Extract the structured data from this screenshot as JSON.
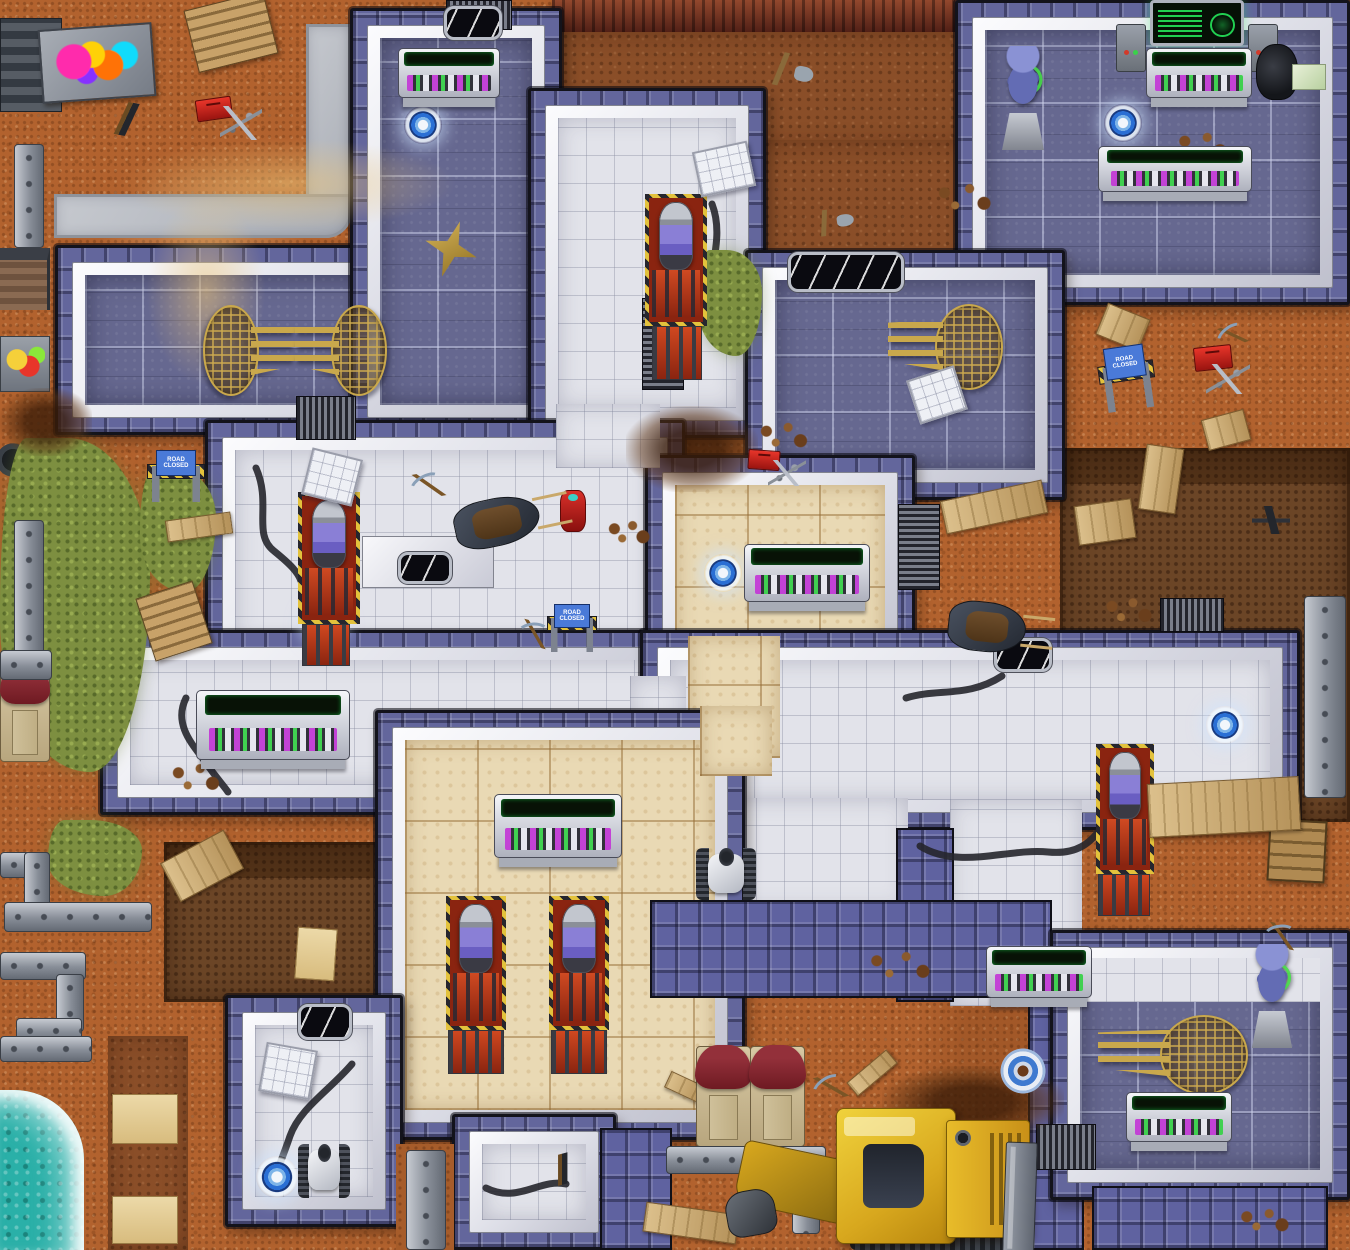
{
  "meta": {
    "title": "Sci-fi facility top-down game map",
    "width": 1350,
    "height": 1250
  },
  "palette": {
    "dirt": "#b2622e",
    "dark_dirt": "#8a4e28",
    "pit": "#5a3a22",
    "cliff": "#6e2a1e",
    "blue_floor": "#666890",
    "white_floor": "#e2e3ea",
    "tan_floor": "#e9d9b4",
    "wall_white": "#dcdde6",
    "wall_pillar": "#63669c",
    "water": "#2ab0a8",
    "grass": "#7d8f40",
    "hazard_yellow": "#e3c23c",
    "teleporter_blue": "#2a6fd4",
    "emblem_gold": "#c9a84c",
    "screen_green": "#28ff64",
    "console_magenta": "#c33bd6",
    "toolbox_red": "#d8302a",
    "bulldozer_yellow": "#d8a81e",
    "porta_potty_roof": "#93303a"
  },
  "signs": {
    "road_closed": "ROAD CLOSED"
  },
  "inventory": {
    "teleporters": 6,
    "target_markers": 1,
    "consoles": 8,
    "wall_screens": 1,
    "hydraulic_presses": 5,
    "robots": 2,
    "alien_statues": 2,
    "gold_emblems": 4,
    "road_closed_barricades": 3,
    "porta_potties": 3,
    "bulldozers": 1,
    "wheelbarrows": 2,
    "toolboxes": 3,
    "graffiti_walls": 1,
    "windows": 5
  },
  "props": [
    {
      "t": "grass",
      "n": "grass-patch",
      "x": 0,
      "y": 438,
      "w": 150,
      "h": 334
    },
    {
      "t": "grass",
      "n": "grass-patch",
      "x": 140,
      "y": 468,
      "w": 76,
      "h": 124
    },
    {
      "t": "grass",
      "n": "grass-patch",
      "x": 48,
      "y": 820,
      "w": 94,
      "h": 76
    },
    {
      "t": "grass",
      "n": "grass-patch",
      "x": 698,
      "y": 250,
      "w": 64,
      "h": 106
    },
    {
      "t": "sand",
      "n": "sand-streak",
      "x": 118,
      "y": 138,
      "w": 340,
      "h": 92
    },
    {
      "t": "sand",
      "n": "sand-streak",
      "x": 146,
      "y": 196,
      "w": 120,
      "h": 190
    },
    {
      "t": "mound",
      "n": "dirt-mound",
      "x": 626,
      "y": 406,
      "w": 132,
      "h": 86
    },
    {
      "t": "mound",
      "n": "dirt-mound",
      "x": 882,
      "y": 1066,
      "w": 182,
      "h": 72
    },
    {
      "t": "mound",
      "n": "dirt-mound",
      "x": 0,
      "y": 388,
      "w": 92,
      "h": 68
    },
    {
      "t": "stones",
      "n": "rock-scatter",
      "x": 930,
      "y": 176,
      "w": 72,
      "h": 42
    },
    {
      "t": "stones",
      "n": "rock-scatter",
      "x": 1172,
      "y": 126,
      "w": 64,
      "h": 38
    },
    {
      "t": "stones",
      "n": "rock-scatter",
      "x": 754,
      "y": 416,
      "w": 62,
      "h": 38
    },
    {
      "t": "stones",
      "n": "rock-scatter",
      "x": 166,
      "y": 756,
      "w": 62,
      "h": 42
    },
    {
      "t": "stones",
      "n": "rock-scatter",
      "x": 860,
      "y": 944,
      "w": 84,
      "h": 42
    },
    {
      "t": "stones",
      "n": "rock-scatter",
      "x": 1234,
      "y": 1204,
      "w": 64,
      "h": 32
    },
    {
      "t": "stones",
      "n": "rock-scatter",
      "x": 604,
      "y": 516,
      "w": 52,
      "h": 32
    },
    {
      "t": "stones",
      "n": "rock-scatter",
      "x": 1100,
      "y": 592,
      "w": 60,
      "h": 36
    },
    {
      "t": "whitepatch",
      "n": "white-floor-strip",
      "x": 1078,
      "y": 958,
      "w": 242,
      "h": 44
    },
    {
      "t": "dirtpatch",
      "n": "girder-alcove-floor",
      "x": 396,
      "y": 1144,
      "w": 58,
      "h": 106
    },
    {
      "t": "emblem",
      "n": "eagle-globe-emblem",
      "x": 203,
      "y": 297,
      "w": 92,
      "h": 103,
      "f": true
    },
    {
      "t": "emblem",
      "n": "eagle-globe-emblem",
      "x": 295,
      "y": 297,
      "w": 92,
      "h": 103
    },
    {
      "t": "emblem",
      "n": "eagle-globe-emblem",
      "x": 888,
      "y": 296,
      "w": 115,
      "h": 98
    },
    {
      "t": "emblem",
      "n": "eagle-globe-emblem",
      "x": 1098,
      "y": 1008,
      "w": 150,
      "h": 90
    },
    {
      "t": "star",
      "n": "gold-star-decal",
      "x": 424,
      "y": 220,
      "w": 54,
      "h": 58,
      "r": 18
    },
    {
      "t": "teleporter",
      "n": "teleporter-pad",
      "x": 404,
      "y": 106,
      "w": 38,
      "h": 38,
      "i": true
    },
    {
      "t": "teleporter",
      "n": "teleporter-pad",
      "x": 1104,
      "y": 104,
      "w": 38,
      "h": 38,
      "i": true
    },
    {
      "t": "teleporter",
      "n": "teleporter-pad",
      "x": 304,
      "y": 604,
      "w": 40,
      "h": 40,
      "i": true
    },
    {
      "t": "teleporter",
      "n": "teleporter-pad",
      "x": 704,
      "y": 554,
      "w": 38,
      "h": 38,
      "i": true
    },
    {
      "t": "teleporter",
      "n": "teleporter-pad",
      "x": 1206,
      "y": 706,
      "w": 38,
      "h": 38,
      "i": true
    },
    {
      "t": "teleporter",
      "n": "teleporter-pad",
      "x": 256,
      "y": 1156,
      "w": 42,
      "h": 42,
      "i": true
    },
    {
      "t": "target",
      "n": "target-marker",
      "x": 998,
      "y": 1046,
      "w": 50,
      "h": 50
    },
    {
      "t": "window",
      "n": "wall-window",
      "x": 444,
      "y": 6,
      "w": 58,
      "h": 34
    },
    {
      "t": "window",
      "n": "wall-window",
      "x": 788,
      "y": 252,
      "w": 116,
      "h": 40
    },
    {
      "t": "window",
      "n": "wall-window",
      "x": 994,
      "y": 638,
      "w": 58,
      "h": 34
    },
    {
      "t": "window",
      "n": "wall-window",
      "x": 298,
      "y": 1004,
      "w": 54,
      "h": 36
    },
    {
      "t": "window",
      "n": "wall-window",
      "x": 398,
      "y": 552,
      "w": 54,
      "h": 32
    },
    {
      "t": "wallscreen",
      "n": "computer-wall-screen",
      "x": 1150,
      "y": 0,
      "w": 94,
      "h": 46,
      "i": true
    },
    {
      "t": "bracket",
      "n": "wall-bracket",
      "x": 1116,
      "y": 24,
      "w": 30,
      "h": 48
    },
    {
      "t": "bracket",
      "n": "wall-bracket",
      "x": 1248,
      "y": 24,
      "w": 30,
      "h": 48
    },
    {
      "t": "console",
      "n": "control-console",
      "x": 398,
      "y": 48,
      "w": 102,
      "h": 50,
      "i": true
    },
    {
      "t": "console",
      "n": "control-console",
      "x": 1146,
      "y": 48,
      "w": 106,
      "h": 50,
      "i": true
    },
    {
      "t": "console",
      "n": "control-console",
      "x": 1098,
      "y": 146,
      "w": 154,
      "h": 46,
      "i": true
    },
    {
      "t": "console",
      "n": "control-console",
      "x": 744,
      "y": 544,
      "w": 126,
      "h": 58,
      "i": true
    },
    {
      "t": "console",
      "n": "control-console",
      "x": 196,
      "y": 690,
      "w": 154,
      "h": 70,
      "i": true
    },
    {
      "t": "console",
      "n": "control-console",
      "x": 494,
      "y": 794,
      "w": 128,
      "h": 64,
      "i": true
    },
    {
      "t": "console",
      "n": "control-console",
      "x": 986,
      "y": 946,
      "w": 106,
      "h": 52,
      "i": true
    },
    {
      "t": "console",
      "n": "control-console",
      "x": 1126,
      "y": 1092,
      "w": 106,
      "h": 50,
      "i": true
    },
    {
      "t": "press",
      "n": "hydraulic-press",
      "x": 645,
      "y": 194,
      "w": 62,
      "h": 132,
      "i": true
    },
    {
      "t": "press",
      "n": "hydraulic-press",
      "x": 298,
      "y": 492,
      "w": 62,
      "h": 132,
      "i": true
    },
    {
      "t": "press",
      "n": "hydraulic-press",
      "x": 446,
      "y": 896,
      "w": 60,
      "h": 134,
      "i": true
    },
    {
      "t": "press",
      "n": "hydraulic-press",
      "x": 549,
      "y": 896,
      "w": 60,
      "h": 134,
      "i": true
    },
    {
      "t": "press",
      "n": "hydraulic-press",
      "x": 1096,
      "y": 744,
      "w": 58,
      "h": 130,
      "i": true
    },
    {
      "t": "grate",
      "n": "floor-grate",
      "x": 652,
      "y": 326,
      "w": 50,
      "h": 54
    },
    {
      "t": "grate",
      "n": "floor-grate",
      "x": 302,
      "y": 624,
      "w": 48,
      "h": 42
    },
    {
      "t": "grate",
      "n": "floor-grate",
      "x": 448,
      "y": 1030,
      "w": 56,
      "h": 44
    },
    {
      "t": "grate",
      "n": "floor-grate",
      "x": 551,
      "y": 1030,
      "w": 56,
      "h": 44
    },
    {
      "t": "grate",
      "n": "floor-grate",
      "x": 1098,
      "y": 874,
      "w": 52,
      "h": 42
    },
    {
      "t": "statue",
      "n": "alien-statue",
      "x": 998,
      "y": 46,
      "w": 50,
      "h": 104,
      "i": true
    },
    {
      "t": "statue",
      "n": "alien-statue",
      "x": 1248,
      "y": 944,
      "w": 48,
      "h": 104,
      "i": true
    },
    {
      "t": "robot",
      "n": "tracked-robot",
      "x": 696,
      "y": 848,
      "w": 60,
      "h": 52,
      "i": true
    },
    {
      "t": "robot",
      "n": "tracked-robot",
      "x": 298,
      "y": 1144,
      "w": 52,
      "h": 54,
      "i": true
    },
    {
      "t": "chair",
      "n": "office-chair",
      "x": 1256,
      "y": 44,
      "w": 42,
      "h": 56,
      "i": true
    },
    {
      "t": "papers",
      "n": "map-papers",
      "x": 1292,
      "y": 64,
      "w": 34,
      "h": 26
    },
    {
      "t": "panel",
      "n": "loose-floor-panel",
      "x": 696,
      "y": 146,
      "w": 56,
      "h": 46,
      "r": -12
    },
    {
      "t": "panel",
      "n": "loose-floor-panel",
      "x": 306,
      "y": 453,
      "w": 52,
      "h": 48,
      "r": 14
    },
    {
      "t": "panel",
      "n": "loose-floor-panel",
      "x": 912,
      "y": 372,
      "w": 50,
      "h": 46,
      "r": -18
    },
    {
      "t": "panel",
      "n": "loose-floor-panel",
      "x": 262,
      "y": 1046,
      "w": 52,
      "h": 50,
      "r": 10
    },
    {
      "t": "slab",
      "n": "metal-slab-stack",
      "x": 0,
      "y": 18,
      "w": 62,
      "h": 94
    },
    {
      "t": "graffiti",
      "n": "graffiti-wall",
      "x": 40,
      "y": 26,
      "w": 114,
      "h": 74,
      "r": -4
    },
    {
      "t": "pallet",
      "n": "wood-pallet",
      "x": 190,
      "y": 0,
      "w": 82,
      "h": 64,
      "r": -14
    },
    {
      "t": "pallet",
      "n": "wood-pallet",
      "x": 144,
      "y": 588,
      "w": 60,
      "h": 66,
      "r": -18
    },
    {
      "t": "crate",
      "n": "wood-crate",
      "x": 1268,
      "y": 820,
      "w": 58,
      "h": 62,
      "r": 3
    },
    {
      "t": "plank",
      "n": "wood-plank",
      "x": 942,
      "y": 490,
      "w": 104,
      "h": 34,
      "r": -12
    },
    {
      "t": "plank",
      "n": "wood-log",
      "x": 1100,
      "y": 310,
      "w": 46,
      "h": 34,
      "r": 22
    },
    {
      "t": "plank",
      "n": "wood-log",
      "x": 1204,
      "y": 414,
      "w": 44,
      "h": 32,
      "r": -15
    },
    {
      "t": "plank",
      "n": "wood-plank",
      "x": 1142,
      "y": 446,
      "w": 38,
      "h": 66,
      "r": 8
    },
    {
      "t": "plank",
      "n": "wood-plank",
      "x": 1076,
      "y": 502,
      "w": 58,
      "h": 40,
      "r": -8
    },
    {
      "t": "plank",
      "n": "plank-bridge",
      "x": 1148,
      "y": 780,
      "w": 152,
      "h": 54,
      "r": -3
    },
    {
      "t": "plank",
      "n": "wood-plank",
      "x": 166,
      "y": 844,
      "w": 72,
      "h": 44,
      "r": -28
    },
    {
      "t": "plank",
      "n": "wood-plank",
      "x": 644,
      "y": 1208,
      "w": 94,
      "h": 30,
      "r": 8
    },
    {
      "t": "plank",
      "n": "wood-scrap",
      "x": 846,
      "y": 1064,
      "w": 52,
      "h": 18,
      "r": -40
    },
    {
      "t": "plank",
      "n": "wood-scrap",
      "x": 666,
      "y": 1078,
      "w": 38,
      "h": 18,
      "r": 25
    },
    {
      "t": "plank",
      "n": "wood-log",
      "x": 166,
      "y": 516,
      "w": 66,
      "h": 22,
      "r": -8
    },
    {
      "t": "board",
      "n": "trench-board",
      "x": 296,
      "y": 928,
      "w": 40,
      "h": 52,
      "r": 4
    },
    {
      "t": "board",
      "n": "trench-board",
      "x": 112,
      "y": 1094,
      "w": 66,
      "h": 50
    },
    {
      "t": "board",
      "n": "trench-board",
      "x": 112,
      "y": 1196,
      "w": 66,
      "h": 48
    },
    {
      "t": "toolbox",
      "n": "red-toolbox",
      "x": 196,
      "y": 98,
      "w": 36,
      "h": 22,
      "r": -8
    },
    {
      "t": "toolbox",
      "n": "red-toolbox",
      "x": 748,
      "y": 450,
      "w": 32,
      "h": 20,
      "r": 4
    },
    {
      "t": "toolbox",
      "n": "red-toolbox",
      "x": 1194,
      "y": 346,
      "w": 38,
      "h": 24,
      "r": -6
    },
    {
      "t": "tools",
      "n": "tool-scatter",
      "x": 220,
      "y": 106,
      "w": 42,
      "h": 34
    },
    {
      "t": "tools",
      "n": "tool-scatter",
      "x": 768,
      "y": 460,
      "w": 38,
      "h": 26
    },
    {
      "t": "tools",
      "n": "tool-scatter",
      "x": 1206,
      "y": 364,
      "w": 44,
      "h": 30
    },
    {
      "t": "rifle",
      "n": "rifle",
      "x": 100,
      "y": 102,
      "w": 54,
      "h": 34,
      "r": 10
    },
    {
      "t": "rifle",
      "n": "rifle",
      "x": 540,
      "y": 1154,
      "w": 46,
      "h": 30,
      "r": -15
    },
    {
      "t": "gun",
      "n": "pistol",
      "x": 1252,
      "y": 506,
      "w": 38,
      "h": 28
    },
    {
      "t": "pickaxe",
      "n": "pickaxe",
      "x": 406,
      "y": 472,
      "w": 46,
      "h": 26,
      "r": -10
    },
    {
      "t": "pickaxe",
      "n": "pickaxe",
      "x": 514,
      "y": 622,
      "w": 42,
      "h": 24,
      "r": 15
    },
    {
      "t": "pickaxe",
      "n": "pickaxe",
      "x": 1212,
      "y": 324,
      "w": 42,
      "h": 22,
      "r": -20
    },
    {
      "t": "pickaxe",
      "n": "pickaxe",
      "x": 1260,
      "y": 924,
      "w": 44,
      "h": 24,
      "r": 10
    },
    {
      "t": "pickaxe",
      "n": "pickaxe",
      "x": 808,
      "y": 1074,
      "w": 46,
      "h": 26,
      "r": -15
    },
    {
      "t": "shovel",
      "n": "shovel",
      "x": 750,
      "y": 52,
      "w": 64,
      "h": 34,
      "r": 12
    },
    {
      "t": "shovel",
      "n": "shovel",
      "x": 796,
      "y": 210,
      "w": 58,
      "h": 26,
      "r": -8
    },
    {
      "t": "hydrant",
      "n": "red-canister",
      "x": 560,
      "y": 490,
      "w": 26,
      "h": 42
    },
    {
      "t": "barricade",
      "n": "road-closed-barricade",
      "x": 146,
      "y": 450,
      "w": 60,
      "h": 52,
      "i": true
    },
    {
      "t": "barricade",
      "n": "road-closed-barricade",
      "x": 546,
      "y": 604,
      "w": 52,
      "h": 48,
      "i": true
    },
    {
      "t": "barricade",
      "n": "road-closed-barricade",
      "x": 1098,
      "y": 346,
      "w": 58,
      "h": 64,
      "r": -8,
      "i": true
    },
    {
      "t": "portapotty",
      "n": "porta-potty",
      "x": 0,
      "y": 662,
      "w": 50,
      "h": 100
    },
    {
      "t": "portapotty",
      "n": "porta-potty",
      "x": 696,
      "y": 1046,
      "w": 55,
      "h": 101
    },
    {
      "t": "portapotty",
      "n": "porta-potty",
      "x": 750,
      "y": 1046,
      "w": 55,
      "h": 101
    },
    {
      "t": "wheelbarrow",
      "n": "wheelbarrow",
      "x": 454,
      "y": 498,
      "w": 86,
      "h": 48,
      "r": -12
    },
    {
      "t": "wheelbarrow",
      "n": "wheelbarrow",
      "x": 948,
      "y": 602,
      "w": 78,
      "h": 50,
      "r": 6
    },
    {
      "t": "girder",
      "n": "steel-girder",
      "x": 14,
      "y": 144,
      "w": 30,
      "h": 104
    },
    {
      "t": "girder",
      "n": "steel-girder",
      "x": 14,
      "y": 520,
      "w": 30,
      "h": 144
    },
    {
      "t": "girder",
      "n": "steel-girder",
      "x": 0,
      "y": 650,
      "w": 52,
      "h": 30
    },
    {
      "t": "girder",
      "n": "steel-barrier",
      "x": 0,
      "y": 852,
      "w": 50,
      "h": 26
    },
    {
      "t": "girder",
      "n": "steel-barrier",
      "x": 24,
      "y": 852,
      "w": 26,
      "h": 64
    },
    {
      "t": "girder",
      "n": "steel-barrier",
      "x": 4,
      "y": 902,
      "w": 148,
      "h": 30
    },
    {
      "t": "girder",
      "n": "steel-barrier",
      "x": 0,
      "y": 952,
      "w": 86,
      "h": 28
    },
    {
      "t": "girder",
      "n": "steel-barrier",
      "x": 56,
      "y": 974,
      "w": 28,
      "h": 58
    },
    {
      "t": "girder",
      "n": "steel-barrier",
      "x": 16,
      "y": 1018,
      "w": 66,
      "h": 26
    },
    {
      "t": "girder",
      "n": "steel-barrier",
      "x": 0,
      "y": 1036,
      "w": 92,
      "h": 26
    },
    {
      "t": "girder",
      "n": "steel-girder",
      "x": 406,
      "y": 1150,
      "w": 40,
      "h": 100
    },
    {
      "t": "girder",
      "n": "steel-girder",
      "x": 1304,
      "y": 596,
      "w": 42,
      "h": 202
    },
    {
      "t": "girder",
      "n": "steel-barrier",
      "x": 666,
      "y": 1146,
      "w": 160,
      "h": 28
    },
    {
      "t": "girder",
      "n": "steel-barrier",
      "x": 792,
      "y": 1168,
      "w": 28,
      "h": 66
    },
    {
      "t": "dozerarm",
      "n": "bulldozer-arm",
      "x": 738,
      "y": 1150,
      "w": 112,
      "h": 64,
      "r": 12
    },
    {
      "t": "dozerbucket",
      "n": "bulldozer-bucket",
      "x": 726,
      "y": 1190,
      "w": 50,
      "h": 46,
      "r": -10
    },
    {
      "t": "tread",
      "n": "bulldozer-tracks",
      "x": 850,
      "y": 1224,
      "w": 160,
      "h": 26
    },
    {
      "t": "dozercab",
      "n": "bulldozer-cab",
      "x": 836,
      "y": 1108,
      "w": 120,
      "h": 136,
      "i": true
    },
    {
      "t": "dozerengine",
      "n": "bulldozer-engine",
      "x": 946,
      "y": 1120,
      "w": 84,
      "h": 118
    },
    {
      "t": "dozerblade",
      "n": "bulldozer-blade",
      "x": 1004,
      "y": 1142,
      "w": 32,
      "h": 112,
      "r": 2
    }
  ]
}
